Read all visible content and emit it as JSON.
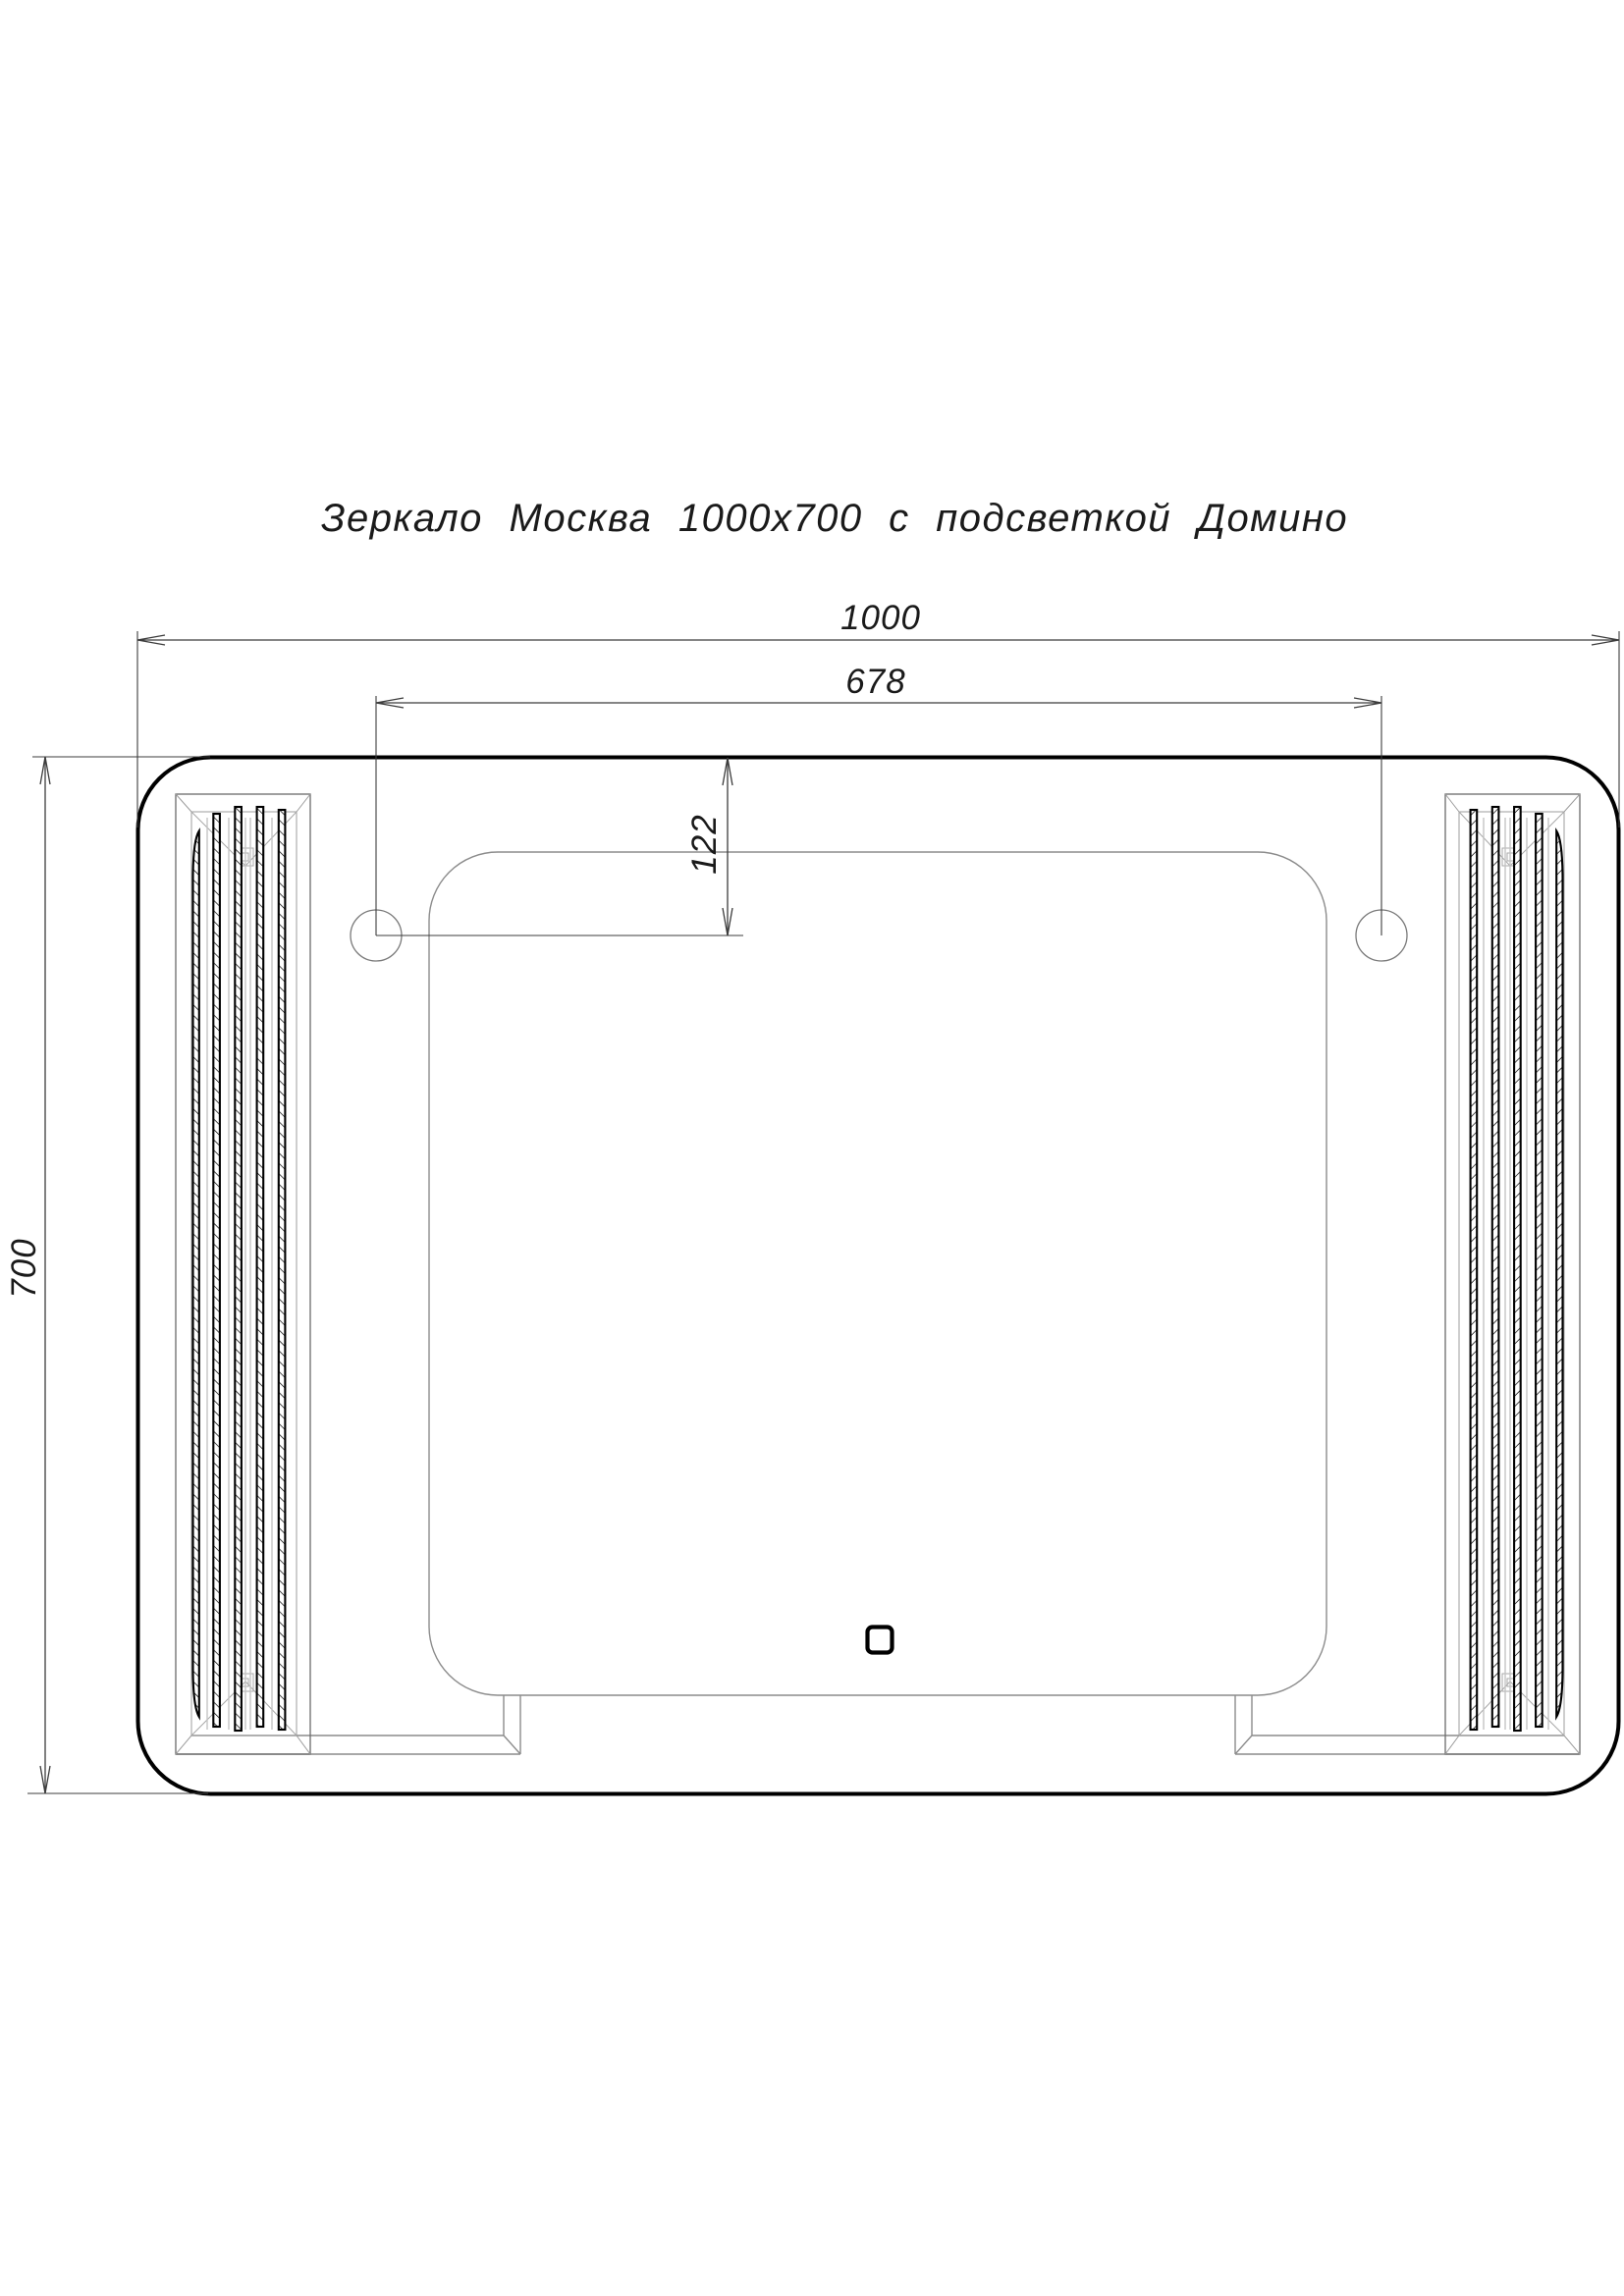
{
  "title": "Зеркало Москва 1000х700 с подсветкой Домино",
  "dims": {
    "width": "1000",
    "hole_spacing": "678",
    "hole_top_offset": "122",
    "height": "700"
  },
  "colors": {
    "background": "#ffffff",
    "outline": "#000000",
    "dimension_lines": "#3c3c3c",
    "object_lines": "#8c8c8c",
    "text": "#1a1a1a"
  }
}
